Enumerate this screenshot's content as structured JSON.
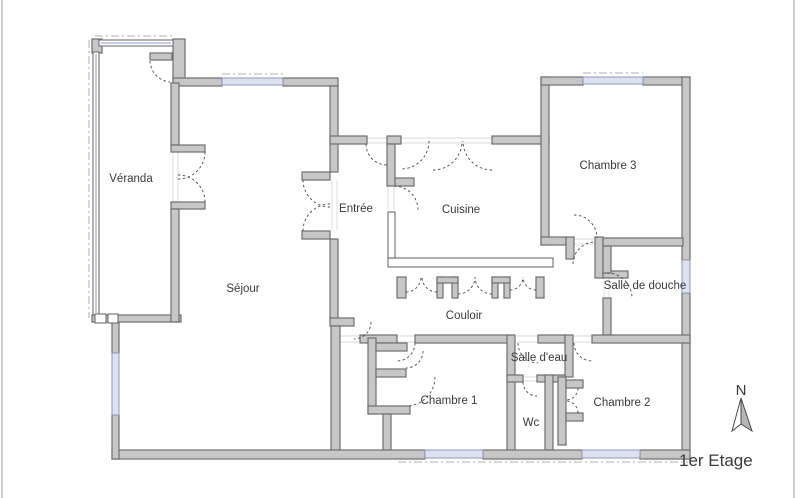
{
  "title_block": {
    "floor_label": "1er Etage",
    "north_label": "N"
  },
  "colors": {
    "wall_fill": "#c7c7c7",
    "wall_stroke": "#6e6e6e",
    "thin_wall_fill": "#ffffff",
    "window_fill": "#dce2f0",
    "window_stroke": "#8d97bd",
    "glaze_line": "#9daad6",
    "door_arc": "#4a4a4a",
    "dashdot": "#b0b0b0",
    "hairline": "#d9d9d9",
    "text": "#3a3a3a",
    "page_border": "#bdbdbd",
    "north_fill": "#b5b5b5"
  },
  "plan": {
    "rooms": [
      {
        "id": "veranda",
        "name": "Véranda",
        "label_x": 131,
        "label_y": 182
      },
      {
        "id": "sejour",
        "name": "Séjour",
        "label_x": 243,
        "label_y": 292
      },
      {
        "id": "entree",
        "name": "Entrée",
        "label_x": 356,
        "label_y": 212
      },
      {
        "id": "cuisine",
        "name": "Cuisine",
        "label_x": 461,
        "label_y": 213
      },
      {
        "id": "chambre-3",
        "name": "Chambre 3",
        "label_x": 608,
        "label_y": 169
      },
      {
        "id": "salle-de-douche",
        "name": "Salle de douche",
        "label_x": 645,
        "label_y": 289
      },
      {
        "id": "couloir",
        "name": "Couloir",
        "label_x": 464,
        "label_y": 319
      },
      {
        "id": "chambre-1",
        "name": "Chambre 1",
        "label_x": 449,
        "label_y": 404
      },
      {
        "id": "salle-d-eau",
        "name": "Salle d'eau",
        "label_x": 539,
        "label_y": 361
      },
      {
        "id": "wc",
        "name": "Wc",
        "label_x": 531,
        "label_y": 426
      },
      {
        "id": "chambre-2",
        "name": "Chambre 2",
        "label_x": 622,
        "label_y": 406
      }
    ],
    "walls": [
      [
        92,
        39,
        10,
        14
      ],
      [
        173,
        39,
        12,
        45
      ],
      [
        173,
        78,
        49,
        8
      ],
      [
        283,
        78,
        55,
        8
      ],
      [
        330,
        86,
        8,
        86
      ],
      [
        302,
        172,
        28,
        8
      ],
      [
        302,
        231,
        28,
        8
      ],
      [
        330,
        239,
        8,
        83
      ],
      [
        330,
        318,
        24,
        8
      ],
      [
        331,
        326,
        9,
        127
      ],
      [
        330,
        136,
        37,
        8
      ],
      [
        387,
        136,
        14,
        8
      ],
      [
        492,
        136,
        57,
        8
      ],
      [
        387,
        144,
        8,
        42
      ],
      [
        395,
        178,
        19,
        8
      ],
      [
        541,
        77,
        8,
        168
      ],
      [
        541,
        77,
        42,
        8
      ],
      [
        643,
        77,
        47,
        8
      ],
      [
        682,
        77,
        8,
        183
      ],
      [
        682,
        293,
        8,
        166
      ],
      [
        541,
        237,
        25,
        8
      ],
      [
        566,
        237,
        8,
        22
      ],
      [
        595,
        237,
        8,
        41
      ],
      [
        603,
        271,
        25,
        7
      ],
      [
        603,
        238,
        80,
        8
      ],
      [
        603,
        246,
        8,
        27
      ],
      [
        603,
        298,
        8,
        37
      ],
      [
        592,
        335,
        98,
        8
      ],
      [
        360,
        335,
        37,
        8
      ],
      [
        415,
        335,
        94,
        8
      ],
      [
        538,
        335,
        27,
        8
      ],
      [
        507,
        335,
        8,
        118
      ],
      [
        565,
        335,
        8,
        42
      ],
      [
        507,
        375,
        16,
        7
      ],
      [
        537,
        375,
        28,
        7
      ],
      [
        545,
        375,
        8,
        75
      ],
      [
        558,
        377,
        8,
        68
      ],
      [
        566,
        380,
        17,
        8
      ],
      [
        566,
        413,
        17,
        8
      ],
      [
        368,
        338,
        8,
        76
      ],
      [
        376,
        343,
        31,
        8
      ],
      [
        376,
        369,
        30,
        8
      ],
      [
        368,
        406,
        42,
        8
      ],
      [
        383,
        414,
        8,
        39
      ],
      [
        112,
        450,
        313,
        9
      ],
      [
        483,
        450,
        99,
        9
      ],
      [
        640,
        450,
        50,
        9
      ],
      [
        112,
        322,
        7,
        31
      ],
      [
        112,
        415,
        7,
        44
      ],
      [
        92,
        315,
        89,
        7
      ],
      [
        171,
        83,
        8,
        62
      ],
      [
        171,
        145,
        34,
        7
      ],
      [
        171,
        202,
        34,
        7
      ],
      [
        171,
        209,
        8,
        113
      ],
      [
        150,
        53,
        22,
        7
      ],
      [
        397,
        277,
        9,
        21
      ],
      [
        437,
        277,
        6,
        21
      ],
      [
        452,
        277,
        6,
        21
      ],
      [
        437,
        277,
        21,
        6
      ],
      [
        492,
        277,
        6,
        21
      ],
      [
        504,
        277,
        6,
        21
      ],
      [
        492,
        277,
        18,
        6
      ],
      [
        536,
        277,
        8,
        21
      ]
    ],
    "thin_walls": [
      [
        93,
        52,
        6,
        263
      ],
      [
        99,
        40,
        74,
        6
      ],
      [
        388,
        258,
        165,
        9
      ],
      [
        388,
        212,
        7,
        46
      ],
      [
        95,
        314,
        11,
        9
      ],
      [
        108,
        314,
        10,
        9
      ]
    ],
    "glaze_lines": [
      [
        96,
        54,
        96,
        313
      ],
      [
        101,
        43,
        171,
        43
      ]
    ],
    "windows": [
      [
        222,
        78,
        61,
        7
      ],
      [
        583,
        77,
        60,
        7
      ],
      [
        682,
        260,
        8,
        33
      ],
      [
        112,
        353,
        7,
        62
      ],
      [
        425,
        450,
        58,
        8
      ],
      [
        582,
        450,
        58,
        8
      ]
    ],
    "dashdot_lines": [
      [
        95,
        36,
        175,
        36
      ],
      [
        222,
        74,
        283,
        74
      ],
      [
        583,
        73,
        643,
        73
      ],
      [
        89,
        40,
        89,
        318
      ],
      [
        398,
        462,
        688,
        462
      ],
      [
        115,
        353,
        115,
        415
      ],
      [
        686,
        260,
        686,
        293
      ],
      [
        425,
        454,
        483,
        454
      ],
      [
        582,
        454,
        640,
        454
      ],
      [
        222,
        81,
        283,
        81
      ],
      [
        583,
        80,
        643,
        80
      ]
    ],
    "hairlines": [
      [
        397,
        336,
        415,
        336
      ],
      [
        397,
        342,
        415,
        342
      ],
      [
        517,
        336,
        538,
        336
      ],
      [
        517,
        342,
        538,
        342
      ],
      [
        573,
        336,
        592,
        336
      ],
      [
        573,
        342,
        592,
        342
      ],
      [
        566,
        239,
        597,
        239
      ],
      [
        566,
        244,
        597,
        244
      ],
      [
        401,
        138,
        492,
        138
      ],
      [
        401,
        143,
        492,
        143
      ],
      [
        367,
        138,
        387,
        138
      ],
      [
        367,
        143,
        387,
        143
      ],
      [
        388,
        186,
        388,
        210
      ],
      [
        394,
        186,
        394,
        210
      ],
      [
        332,
        180,
        332,
        231
      ],
      [
        337,
        180,
        337,
        231
      ],
      [
        173,
        152,
        173,
        202
      ],
      [
        178,
        152,
        178,
        202
      ],
      [
        523,
        377,
        537,
        377
      ],
      [
        523,
        381,
        537,
        381
      ],
      [
        604,
        273,
        604,
        298
      ],
      [
        609,
        273,
        609,
        298
      ],
      [
        340,
        336,
        360,
        336
      ],
      [
        340,
        342,
        360,
        342
      ]
    ],
    "door_arcs": [
      "M 150 61 A 22 22 0 0 0 170 82",
      "M 205 152 A 27 27 0 0 1 178 179",
      "M 205 202 A 27 27 0 0 0 178 175",
      "M 303 180 A 27 27 0 0 0 330 207",
      "M 303 231 A 27 27 0 0 1 330 204",
      "M 394 186 A 24 24 0 0 1 418 210",
      "M 429 141 A 28 28 0 0 1 401 169",
      "M 433 170 A 29 29 0 0 0 462 141",
      "M 492 170 A 29 29 0 0 1 463 141",
      "M 366 144 A 21 21 0 0 0 387 165",
      "M 574 215 A 23 23 0 0 1 597 238",
      "M 573 264 A 22 22 0 0 1 595 242",
      "M 607 273 A 25 25 0 0 1 632 298",
      "M 406 292 A 15 15 0 0 0 421 277",
      "M 437 292 A 15 15 0 0 1 422 277",
      "M 458 294 A 17 17 0 0 0 475 277",
      "M 492 294 A 17 17 0 0 1 475 277",
      "M 510 290 A 13 13 0 0 0 523 277",
      "M 536 290 A 13 13 0 0 1 523 277",
      "M 371 322 A 17 17 0 0 1 354 339",
      "M 415 343 A 18 18 0 0 1 397 361",
      "M 423 351 A 17 17 0 0 1 406 368",
      "M 435 377 A 29 29 0 0 1 406 406",
      "M 518 343 A 20 20 0 0 0 538 363",
      "M 523 382 A 14 14 0 0 0 537 396",
      "M 574 343 A 18 18 0 0 0 592 361",
      "M 578 388 A 12 12 0 0 1 566 400",
      "M 578 413 A 12 12 0 0 0 566 401"
    ],
    "page_border_lines": [
      [
        2,
        0,
        2,
        498
      ],
      [
        794,
        0,
        794,
        498
      ]
    ],
    "north_arrow": {
      "label_x": 741,
      "label_y": 395,
      "left_half": "M741,398 L732,431 L741,424 Z",
      "right_half": "M741,398 L752,431 L741,424 Z"
    },
    "floor_label_pos": {
      "x": 679,
      "y": 466
    }
  }
}
